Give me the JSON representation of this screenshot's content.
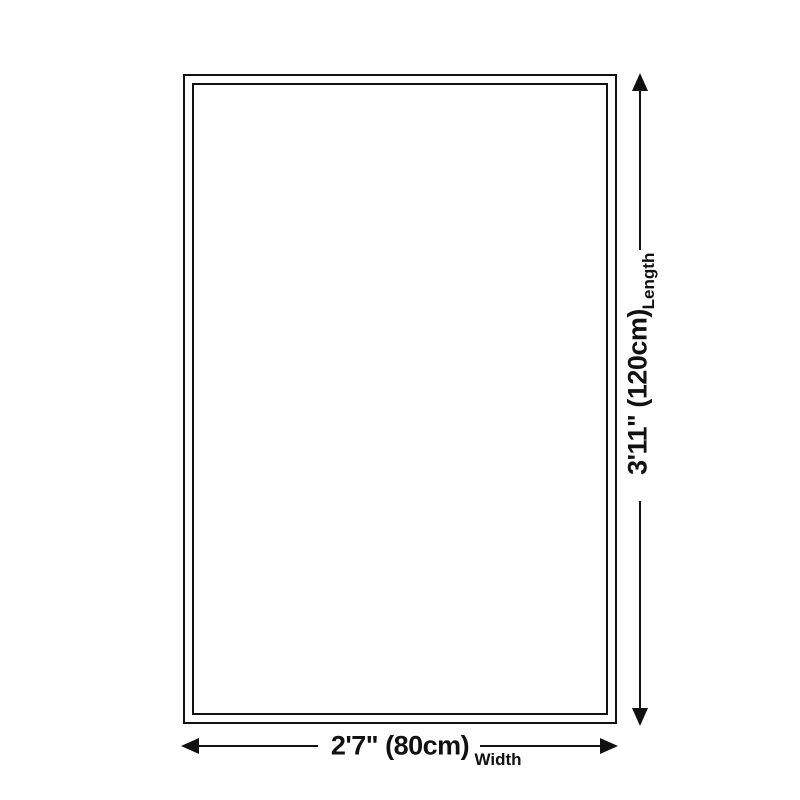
{
  "canvas": {
    "background_color": "#ffffff",
    "ink_color": "#111111"
  },
  "diagram": {
    "type": "product-size-diagram",
    "shape": "rectangle-with-double-border",
    "vertical_dimension": {
      "value": "3'11\" (120cm)",
      "label": "Length"
    },
    "horizontal_dimension": {
      "value": "2'7\" (80cm)",
      "label": "Width"
    }
  }
}
